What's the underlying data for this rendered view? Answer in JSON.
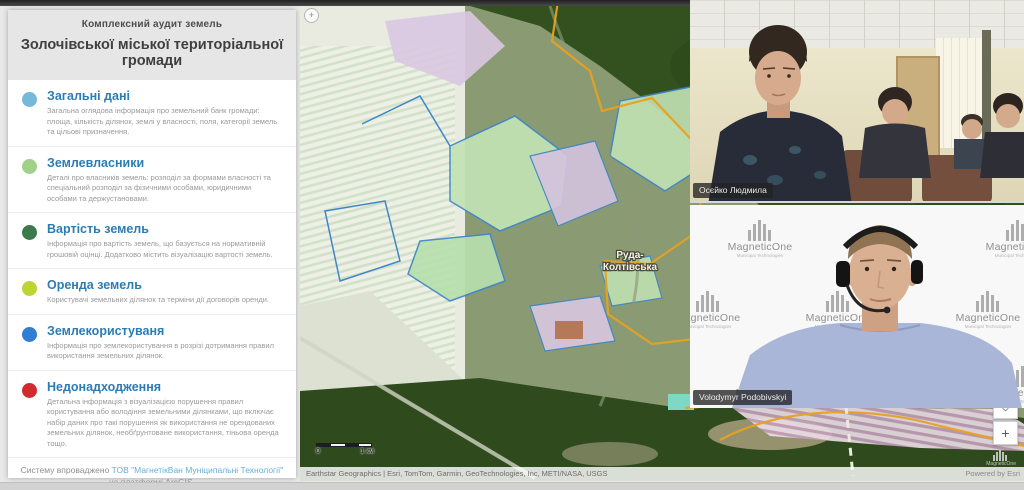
{
  "sidebar": {
    "subtitle": "Комплексний аудит земель",
    "title": "Золочівської міської територіальної громади",
    "sections": [
      {
        "label": "Загальні дані",
        "description": "Загальна оглядова інформація про земельний банк громади: площа, кількість ділянок, землі у власності, поля, категорії земель та цільові призначення.",
        "color": "#74b9d8"
      },
      {
        "label": "Землевласники",
        "description": "Деталі про власників земель: розподіл за формами власності та спеціальний розподіл за фізичними особами, юридичними особами та держустановами.",
        "color": "#9fd189"
      },
      {
        "label": "Вартість земель",
        "description": "Інформація про вартість земель, що базується на нормативній грошовій оцінці. Додатково містить візуалізацію вартості земель.",
        "color": "#3c7a4c"
      },
      {
        "label": "Оренда земель",
        "description": "Користувачі земельних ділянок та терміни дії договорів оренди.",
        "color": "#bdd433"
      },
      {
        "label": "Землекористуваня",
        "description": "Інформація про землекористування в розрізі дотримання правил використання земельних ділянок.",
        "color": "#2f7ed3"
      },
      {
        "label": "Недонадходження",
        "description": "Детальна інформація з візуалізацією порушення правил користування або володіння земельними ділянками, що включає набір даних про такі порушення як використання не орендованих земельних ділянок, необґрунтоване використання, тіньова оренда тощо.",
        "color": "#d22b2f"
      }
    ],
    "footer_prefix": "Систему впроваджено ",
    "footer_link": "ТОВ \"МагнетікВан Муніципальні Технології\"",
    "footer_suffix": " на платформі ArcGIS.",
    "toggle_glyph": "+"
  },
  "map": {
    "place_line1": "Руда-",
    "place_line2": "Колтівська",
    "scale_zero": "0",
    "scale_km": "1 км",
    "attribution": "Earthstar Geographics | Esri, TomTom, Garmin, GeoTechnologies, Inc, METI/NASA, USGS",
    "powered_by": "Powered by Esri",
    "locate_glyph": "◇",
    "zoom_in_glyph": "+",
    "watermark": "MagneticOne"
  },
  "participants": [
    {
      "name": "Осєйко Людмила"
    },
    {
      "name": "Volodymyr Podobivskyi"
    }
  ],
  "brand": {
    "logo_title": "MagneticOne",
    "logo_subtitle": "Municipal Technologies"
  }
}
